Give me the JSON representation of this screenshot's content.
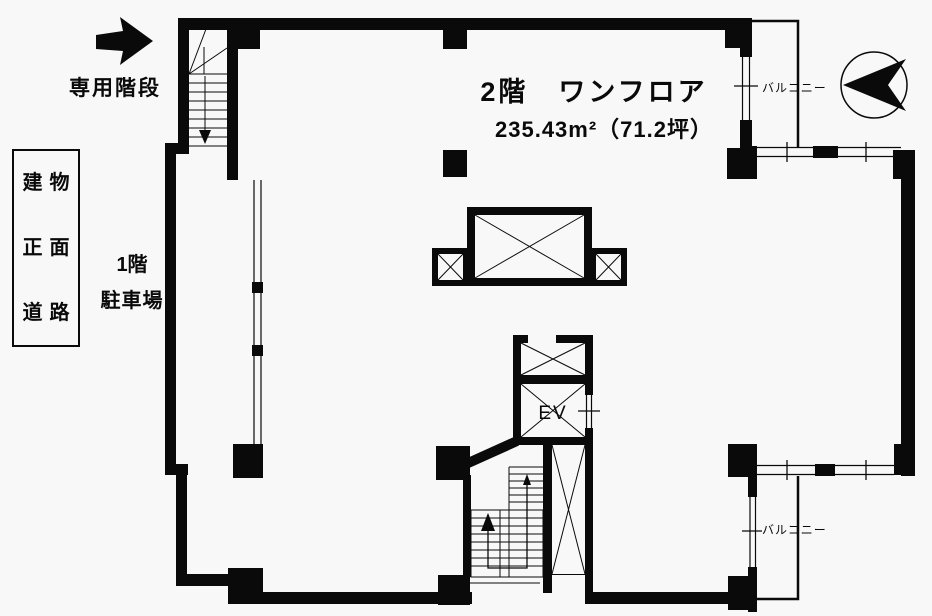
{
  "colors": {
    "ink": "#0a0a0a",
    "background": "#f8f8f8"
  },
  "header": {
    "title": "2階　ワンフロア",
    "area": "235.43m²（71.2坪）"
  },
  "annotations": {
    "private_staircase": "専用階段",
    "front_road_sign": [
      "建物",
      "正面",
      "道路"
    ],
    "parking": [
      "1階",
      "駐車場"
    ],
    "balcony_top": "バルコニー",
    "balcony_bottom": "バルコニー",
    "elevator": "EV"
  }
}
